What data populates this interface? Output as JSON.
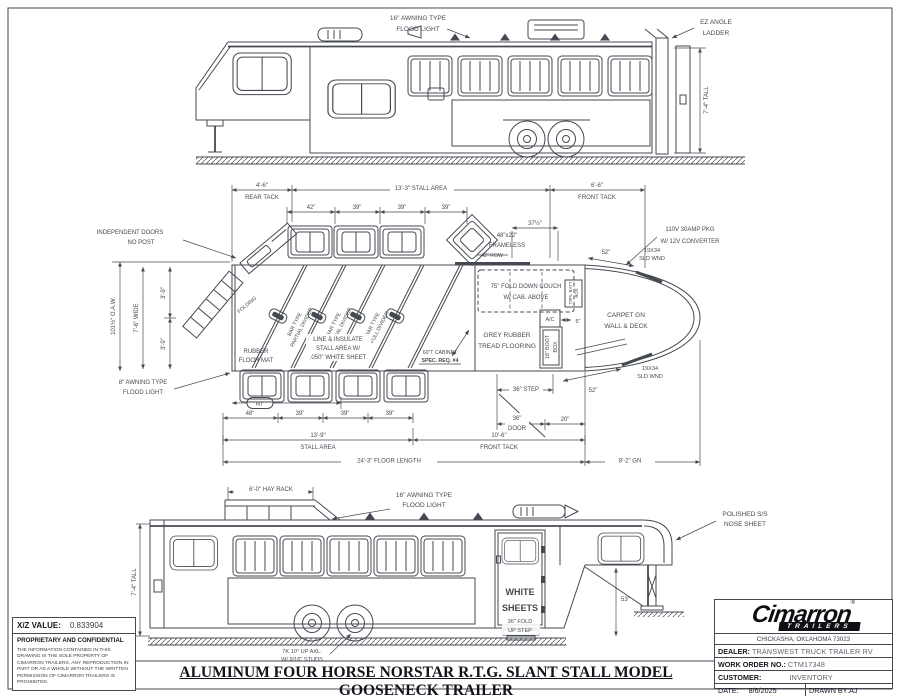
{
  "sheet": {
    "title": "ALUMINUM FOUR HORSE NORSTAR R.T.G. SLANT STALL MODEL GOOSENECK TRAILER"
  },
  "top_view": {
    "flood_light": [
      "16\" AWNING TYPE",
      "FLOOD LIGHT"
    ],
    "ladder": [
      "EZ ANGLE",
      "LADDER"
    ],
    "tall": "7'-4\" TALL"
  },
  "plan": {
    "rear_tack": [
      "4'-6\"",
      "REAR TACK"
    ],
    "stall_area_top": "13'-3\" STALL AREA",
    "front_tack_top": [
      "6'-6\"",
      "FRONT TACK"
    ],
    "w42": "42\"",
    "w39": "39\"",
    "w37h": "37½\"",
    "frameless": [
      "48\"x22\"",
      "FRAMELESS"
    ],
    "row42": "42\" ROW",
    "power": [
      "110V 30AMP PKG",
      "W/ 12V CONVERTER"
    ],
    "d52": "52\"",
    "sld_wnd": [
      "19X34",
      "SLD WND"
    ],
    "independent": [
      "INDEPENDENT DOORS",
      "NO POST"
    ],
    "folding": "FOLDING",
    "oaw": "101½\" O.A.W.",
    "wide": "7'-6\" WIDE",
    "d39v": "3'-9\"",
    "partial_divider": [
      "BAR TYPE",
      "PARTIAL DIVIDER"
    ],
    "full_divider": [
      "BAR TYPE",
      "FULL DIVIDER"
    ],
    "insulate": [
      "LINE & INSULATE",
      "STALL AREA W/",
      ".050\" WHITE SHEET"
    ],
    "cabinet": "60\"T CABINET",
    "spec_req": "SPEC. REQ. #4",
    "couch": [
      "75\" FOLD DOWN COUCH",
      "W/ CAB. ABOVE"
    ],
    "ac": "A/C",
    "d5": "5\"",
    "batt": [
      "TRPL BATT",
      "BOX"
    ],
    "grey_rubber": [
      "GREY RUBBER",
      "TREAD FLOORING"
    ],
    "boot": [
      "18\" BOOT",
      "BOX"
    ],
    "carpet": [
      "CARPET GN",
      "WALL & DECK"
    ],
    "rubber_mat": [
      "RUBBER",
      "FLOOR MAT"
    ],
    "awning8": [
      "8\" AWNING TYPE",
      "FLOOD LIGHT"
    ],
    "d60": "60\"",
    "d48": "48\"",
    "stall_area_bot": [
      "13'-9\"",
      "STALL AREA"
    ],
    "front_tack_bot": [
      "10'-6\"",
      "FRONT TACK"
    ],
    "floor_len": "24'-3\" FLOOR LENGTH",
    "gn_len": "8'-2\" GN",
    "step36": "36\" STEP",
    "door36": [
      "36\"",
      "DOOR"
    ],
    "d20": "20\""
  },
  "bottom_view": {
    "hay_rack": "6'-0\" HAY RACK",
    "flood_light": [
      "16\" AWNING TYPE",
      "FLOOD LIGHT"
    ],
    "nose": [
      "POLISHED S/S",
      "NOSE SHEET"
    ],
    "white_sheets": [
      "WHITE",
      "SHEETS"
    ],
    "d53": "53\"",
    "fold_step": [
      "36\" FOLD",
      "UP STEP"
    ],
    "axle": [
      "7K 10° UP AXL.",
      "W/ 9/16\" STUDS"
    ],
    "tall": "7'-4\" TALL"
  },
  "info_block": {
    "xz_label": "X/Z VALUE:",
    "xz_value": "0.833904",
    "confidential": "PROPRIETARY AND CONFIDENTIAL",
    "legal": "THE INFORMATION CONTAINED IN THIS DRAWING IS THE SOLE PROPERTY OF CIMARRON TRAILERS. ANY REPRODUCTION IN PART OR AS A WHOLE WITHOUT THE WRITTEN PERMISSION OF CIMARRON TRAILERS IS PROHIBITED."
  },
  "title_block": {
    "brand": "Cimarron",
    "brand_sub": "TRAILERS",
    "reg": "®",
    "address": "CHICKASHA, OKLAHOMA 73023",
    "dealer_label": "DEALER:",
    "dealer": "TRANSWEST TRUCK TRAILER RV",
    "wo_label": "WORK ORDER NO.:",
    "wo": "CTM17348",
    "customer_label": "CUSTOMER:",
    "customer": "INVENTORY",
    "date_label": "DATE:",
    "date": "8/6/2025",
    "drawn_label": "DRAWN BY:",
    "drawn": "AJ"
  }
}
